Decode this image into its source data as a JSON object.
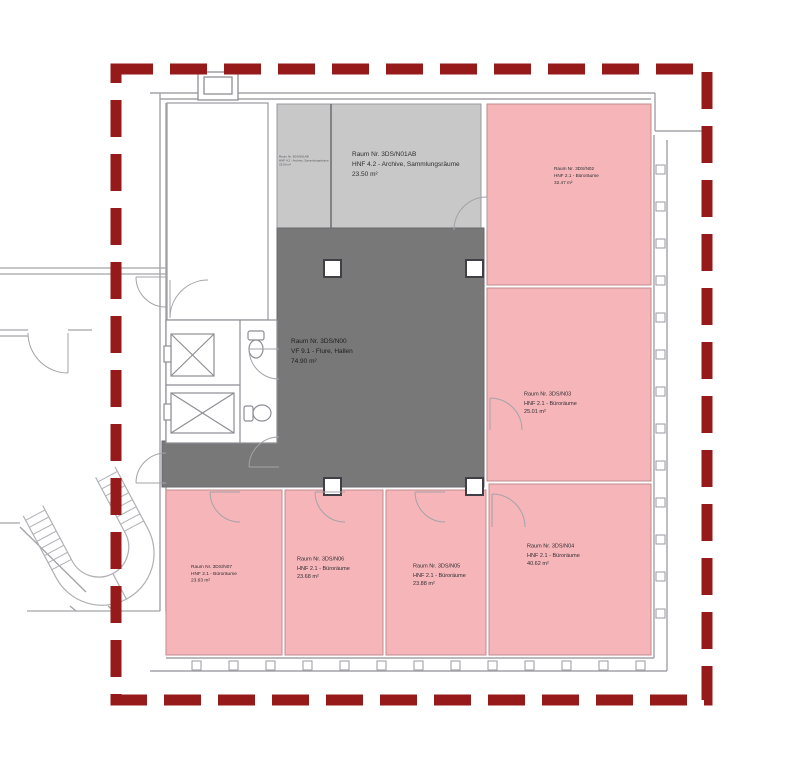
{
  "colors": {
    "boundary": "#961a1a",
    "room_pink": "#f6b6b9",
    "room_gray": "#c8c8c8",
    "corridor_gray": "#787878",
    "wall_line": "#a3a3a8"
  },
  "rooms": [
    {
      "id": "3DS/N01AB",
      "name": "Raum Nr. 3DS/N01AB",
      "type": "HNF 4.2 - Archive, Sammlungsräume",
      "area": "23.50 m²"
    },
    {
      "id": "3DS/N02",
      "name": "Raum Nr. 3DS/N02",
      "type": "HNF 2.1 - Büroräume",
      "area": "32.47 m²"
    },
    {
      "id": "3DS/N00",
      "name": "Raum Nr. 3DS/N00",
      "type": "VF 9.1 - Flure, Hallen",
      "area": "74.90 m²"
    },
    {
      "id": "3DS/N03",
      "name": "Raum Nr. 3DS/N03",
      "type": "HNF 2.1 - Büroräume",
      "area": "25.01 m²"
    },
    {
      "id": "3DS/N04",
      "name": "Raum Nr. 3DS/N04",
      "type": "HNF 2.1 - Büroräume",
      "area": "40.62 m²"
    },
    {
      "id": "3DS/N05",
      "name": "Raum Nr. 3DS/N05",
      "type": "HNF 2.1 - Büroräume",
      "area": "23.88 m²"
    },
    {
      "id": "3DS/N06",
      "name": "Raum Nr. 3DS/N06",
      "type": "HNF 2.1 - Büroräume",
      "area": "23.68 m²"
    },
    {
      "id": "3DS/N07",
      "name": "Raum Nr. 3DS/N07",
      "type": "HNF 2.1 - Büroräume",
      "area": "23.63 m²"
    }
  ],
  "mini_label": {
    "name": "Raum Nr. 3DS/N01AB",
    "type": "HNF 4.2 - Archive, Sammlungsräume",
    "area": "23.50 m²"
  }
}
